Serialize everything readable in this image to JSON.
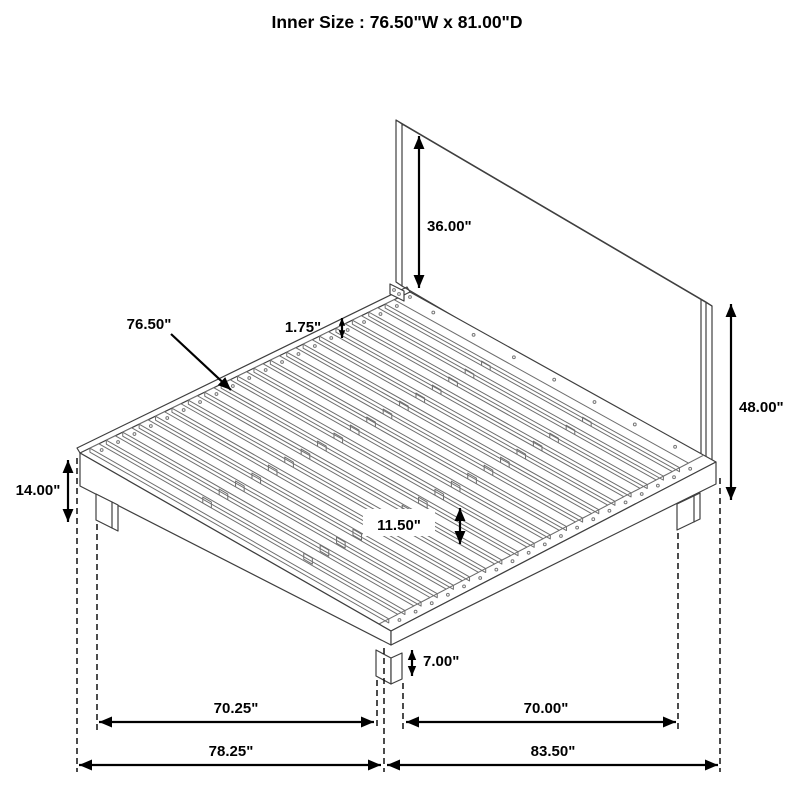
{
  "title": "Inner Size : 76.50\"W x 81.00\"D",
  "labels": {
    "inner_size": "Inner Size : 76.50\"W x 81.00\"D",
    "headboard_height_above_deck": "36.00\"",
    "slat_length": "76.50\"",
    "slat_thickness": "1.75\"",
    "total_height": "48.00\"",
    "base_height": "14.00\"",
    "deck_surface_height": "11.50\"",
    "leg_height": "7.00\"",
    "leg_span_width": "70.25\"",
    "leg_span_depth": "70.00\"",
    "overall_width": "78.25\"",
    "overall_depth": "83.50\""
  },
  "colors": {
    "background": "#ffffff",
    "line": "#000000",
    "structure_line": "#3f3f3f",
    "slat_line": "#6e6e6e"
  }
}
